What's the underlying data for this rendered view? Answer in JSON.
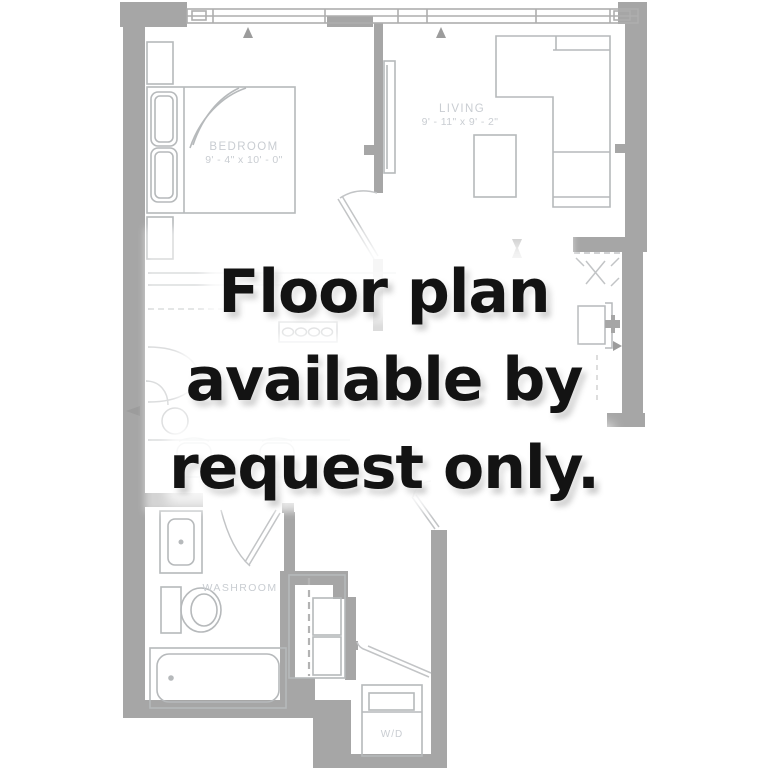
{
  "overlay_message": {
    "line1": "Floor plan",
    "line2": "available by",
    "line3": "request only."
  },
  "floor_plan": {
    "rooms": {
      "bedroom": {
        "name": "BEDROOM",
        "dimensions": "9' - 4\" x 10' - 0\""
      },
      "living": {
        "name": "LIVING",
        "dimensions": "9' - 11\" x 9' - 2\""
      },
      "washroom": {
        "name": "WASHROOM"
      },
      "laundry": {
        "name": "W/D"
      }
    },
    "colors": {
      "wall": "#a6a6a6",
      "furniture_line": "#b6b9bb",
      "room_label": "#c9cdd2",
      "message_text": "#131313",
      "background": "#ffffff"
    }
  }
}
